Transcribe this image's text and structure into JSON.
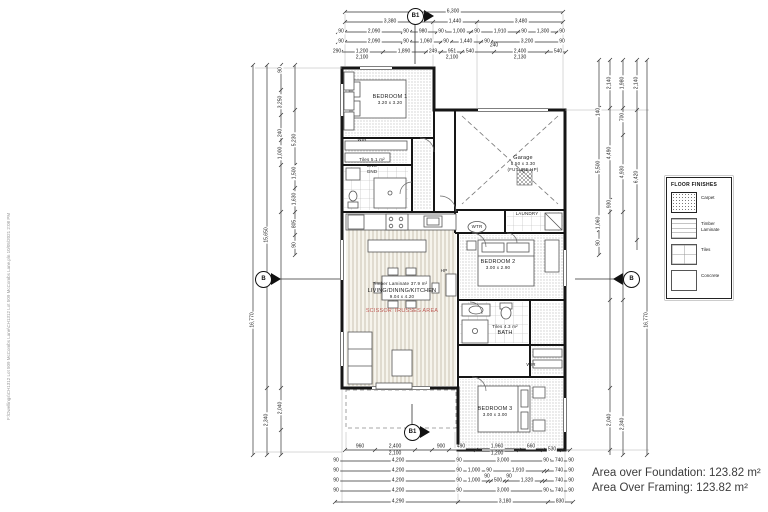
{
  "file_path_text": "F:\\Dwellings\\CH1312 Lot 509 McCombs Lane\\CH1312 Lot 509 McCombs Lane.pln 10/05/2021 2:08 PM",
  "areas": {
    "line1": "Area over Foundation: 123.82 m²",
    "line2": "Area Over Framing: 123.82 m²"
  },
  "markers": {
    "top": "B1",
    "bottom": "B1",
    "left": "B",
    "right": "B"
  },
  "legend": {
    "title": "FLOOR FINISHES",
    "items": [
      {
        "label": "Carpet",
        "swatch": "carpet"
      },
      {
        "label": "Timber Laminate",
        "swatch": "timber"
      },
      {
        "label": "Tiles",
        "swatch": "tiles"
      },
      {
        "label": "Concrete",
        "swatch": "concrete"
      }
    ]
  },
  "room_labels": [
    {
      "t": "BEDROOM 1",
      "x": 390,
      "y": 97
    },
    {
      "t": "3.20 x 3.20",
      "x": 390,
      "y": 103,
      "s": 1
    },
    {
      "t": "WIR",
      "x": 362,
      "y": 140,
      "s": 1
    },
    {
      "t": "Tiles 5.1 m²",
      "x": 372,
      "y": 160,
      "s": 1
    },
    {
      "t": "ENS",
      "x": 372,
      "y": 166,
      "s": 1
    },
    {
      "t": "GND",
      "x": 372,
      "y": 172,
      "s": 1
    },
    {
      "t": "Garage",
      "x": 523,
      "y": 158
    },
    {
      "t": "5.50 x 3.30",
      "x": 523,
      "y": 164,
      "s": 1
    },
    {
      "t": "(FUTURE HP)",
      "x": 523,
      "y": 170,
      "s": 1
    },
    {
      "t": "LAUNDRY",
      "x": 527,
      "y": 214,
      "s": 1
    },
    {
      "t": "WTR",
      "x": 477,
      "y": 227,
      "s": 1
    },
    {
      "t": "BEDROOM 2",
      "x": 498,
      "y": 262
    },
    {
      "t": "3.00 x 2.90",
      "x": 498,
      "y": 268,
      "s": 1
    },
    {
      "t": "Tiles 4.3 m²",
      "x": 505,
      "y": 327,
      "s": 1
    },
    {
      "t": "BATH",
      "x": 505,
      "y": 333
    },
    {
      "t": "WIR",
      "x": 531,
      "y": 365,
      "s": 1
    },
    {
      "t": "BEDROOM 3",
      "x": 495,
      "y": 409
    },
    {
      "t": "3.00 x 3.00",
      "x": 495,
      "y": 415,
      "s": 1
    },
    {
      "t": "Timber Laminate 37.9 m²",
      "x": 400,
      "y": 284,
      "s": 1
    },
    {
      "t": "LIVING/DINING/KITCHEN",
      "x": 402,
      "y": 291
    },
    {
      "t": "9.04 x 4.20",
      "x": 402,
      "y": 297,
      "s": 1
    },
    {
      "t": "SCISSOR TRUSSES AREA",
      "x": 402,
      "y": 311,
      "c": "#bf5b55"
    },
    {
      "t": "HP",
      "x": 444,
      "y": 271,
      "s": 1
    }
  ],
  "dim_labels": [
    {
      "t": "6,300",
      "x": 453,
      "y": 12
    },
    {
      "t": "3,380",
      "x": 390,
      "y": 22
    },
    {
      "t": "1,440",
      "x": 455,
      "y": 22
    },
    {
      "t": "3,480",
      "x": 521,
      "y": 22
    },
    {
      "t": "90",
      "x": 341,
      "y": 32
    },
    {
      "t": "2,090",
      "x": 374,
      "y": 32
    },
    {
      "t": "90",
      "x": 406,
      "y": 32
    },
    {
      "t": "980",
      "x": 423,
      "y": 32
    },
    {
      "t": "90",
      "x": 441,
      "y": 32
    },
    {
      "t": "1,000",
      "x": 459,
      "y": 32
    },
    {
      "t": "90",
      "x": 477,
      "y": 32
    },
    {
      "t": "1,910",
      "x": 500,
      "y": 32
    },
    {
      "t": "90",
      "x": 524,
      "y": 32
    },
    {
      "t": "1,300",
      "x": 543,
      "y": 32
    },
    {
      "t": "90",
      "x": 562,
      "y": 32
    },
    {
      "t": "90",
      "x": 341,
      "y": 42
    },
    {
      "t": "2,090",
      "x": 374,
      "y": 42
    },
    {
      "t": "90",
      "x": 406,
      "y": 42
    },
    {
      "t": "1,060",
      "x": 426,
      "y": 42
    },
    {
      "t": "90",
      "x": 446,
      "y": 42
    },
    {
      "t": "1,440",
      "x": 466,
      "y": 42
    },
    {
      "t": "90",
      "x": 487,
      "y": 42
    },
    {
      "t": "240",
      "x": 494,
      "y": 46
    },
    {
      "t": "3,200",
      "x": 527,
      "y": 42
    },
    {
      "t": "90",
      "x": 562,
      "y": 42
    },
    {
      "t": "290",
      "x": 337,
      "y": 52
    },
    {
      "t": "1,200",
      "x": 362,
      "y": 52
    },
    {
      "t": "1,890",
      "x": 404,
      "y": 52
    },
    {
      "t": "249",
      "x": 433,
      "y": 52
    },
    {
      "t": "951",
      "x": 452,
      "y": 52
    },
    {
      "t": "540",
      "x": 470,
      "y": 52
    },
    {
      "t": "2,400",
      "x": 520,
      "y": 52
    },
    {
      "t": "540",
      "x": 558,
      "y": 52
    },
    {
      "t": "2,100",
      "x": 362,
      "y": 58
    },
    {
      "t": "2,100",
      "x": 452,
      "y": 58
    },
    {
      "t": "2,130",
      "x": 520,
      "y": 58
    },
    {
      "t": "960",
      "x": 360,
      "y": 447
    },
    {
      "t": "2,400",
      "x": 395,
      "y": 447
    },
    {
      "t": "2,100",
      "x": 395,
      "y": 454
    },
    {
      "t": "900",
      "x": 441,
      "y": 447
    },
    {
      "t": "490",
      "x": 461,
      "y": 447
    },
    {
      "t": "1,960",
      "x": 497,
      "y": 447
    },
    {
      "t": "1,200",
      "x": 497,
      "y": 454
    },
    {
      "t": "660",
      "x": 531,
      "y": 447
    },
    {
      "t": "530",
      "x": 552,
      "y": 450
    },
    {
      "t": "90",
      "x": 336,
      "y": 461
    },
    {
      "t": "4,200",
      "x": 398,
      "y": 461
    },
    {
      "t": "90",
      "x": 459,
      "y": 461
    },
    {
      "t": "3,000",
      "x": 503,
      "y": 461
    },
    {
      "t": "90",
      "x": 546,
      "y": 461
    },
    {
      "t": "740",
      "x": 559,
      "y": 461
    },
    {
      "t": "90",
      "x": 571,
      "y": 461
    },
    {
      "t": "90",
      "x": 336,
      "y": 471
    },
    {
      "t": "4,200",
      "x": 398,
      "y": 471
    },
    {
      "t": "90",
      "x": 459,
      "y": 471
    },
    {
      "t": "1,000",
      "x": 474,
      "y": 471
    },
    {
      "t": "90",
      "x": 489,
      "y": 471
    },
    {
      "t": "1,910",
      "x": 518,
      "y": 471
    },
    {
      "t": "740",
      "x": 559,
      "y": 471
    },
    {
      "t": "90",
      "x": 571,
      "y": 471
    },
    {
      "t": "90",
      "x": 336,
      "y": 481
    },
    {
      "t": "4,200",
      "x": 398,
      "y": 481
    },
    {
      "t": "90",
      "x": 459,
      "y": 481
    },
    {
      "t": "1,000",
      "x": 474,
      "y": 481
    },
    {
      "t": "90",
      "x": 487,
      "y": 477
    },
    {
      "t": "500",
      "x": 498,
      "y": 481
    },
    {
      "t": "90",
      "x": 509,
      "y": 477
    },
    {
      "t": "1,320",
      "x": 527,
      "y": 481
    },
    {
      "t": "740",
      "x": 559,
      "y": 481
    },
    {
      "t": "90",
      "x": 571,
      "y": 481
    },
    {
      "t": "90",
      "x": 336,
      "y": 491
    },
    {
      "t": "4,200",
      "x": 398,
      "y": 491
    },
    {
      "t": "90",
      "x": 459,
      "y": 491
    },
    {
      "t": "3,000",
      "x": 503,
      "y": 491
    },
    {
      "t": "90",
      "x": 546,
      "y": 491
    },
    {
      "t": "740",
      "x": 559,
      "y": 491
    },
    {
      "t": "90",
      "x": 571,
      "y": 491
    },
    {
      "t": "4,290",
      "x": 398,
      "y": 502
    },
    {
      "t": "3,180",
      "x": 505,
      "y": 502
    },
    {
      "t": "830",
      "x": 560,
      "y": 502
    },
    {
      "t": "16,770",
      "x": 253,
      "y": 320,
      "r": 1
    },
    {
      "t": "15,650",
      "x": 267,
      "y": 235,
      "r": 1
    },
    {
      "t": "2,340",
      "x": 267,
      "y": 420,
      "r": 1
    },
    {
      "t": "90",
      "x": 281,
      "y": 70,
      "r": 1
    },
    {
      "t": "3,250",
      "x": 281,
      "y": 102,
      "r": 1
    },
    {
      "t": "240",
      "x": 281,
      "y": 133,
      "r": 1
    },
    {
      "t": "1,000",
      "x": 281,
      "y": 153,
      "r": 1
    },
    {
      "t": "2,040",
      "x": 281,
      "y": 408,
      "r": 1
    },
    {
      "t": "5,230",
      "x": 295,
      "y": 140,
      "r": 1
    },
    {
      "t": "1,500",
      "x": 295,
      "y": 173,
      "r": 1
    },
    {
      "t": "1,630",
      "x": 295,
      "y": 199,
      "r": 1
    },
    {
      "t": "805",
      "x": 295,
      "y": 224,
      "r": 1
    },
    {
      "t": "90",
      "x": 295,
      "y": 245,
      "r": 1
    },
    {
      "t": "140",
      "x": 599,
      "y": 112,
      "r": 1
    },
    {
      "t": "5,500",
      "x": 599,
      "y": 167,
      "r": 1
    },
    {
      "t": "1,060",
      "x": 599,
      "y": 223,
      "r": 1
    },
    {
      "t": "90",
      "x": 599,
      "y": 243,
      "r": 1
    },
    {
      "t": "2,140",
      "x": 610,
      "y": 83,
      "r": 1
    },
    {
      "t": "4,490",
      "x": 610,
      "y": 153,
      "r": 1
    },
    {
      "t": "930",
      "x": 610,
      "y": 204,
      "r": 1
    },
    {
      "t": "2,040",
      "x": 610,
      "y": 420,
      "r": 1
    },
    {
      "t": "1,980",
      "x": 623,
      "y": 83,
      "r": 1
    },
    {
      "t": "700",
      "x": 623,
      "y": 117,
      "r": 1
    },
    {
      "t": "4,930",
      "x": 623,
      "y": 172,
      "r": 1
    },
    {
      "t": "2,340",
      "x": 623,
      "y": 424,
      "r": 1
    },
    {
      "t": "2,140",
      "x": 637,
      "y": 83,
      "r": 1
    },
    {
      "t": "6,420",
      "x": 637,
      "y": 177,
      "r": 1
    },
    {
      "t": "16,770",
      "x": 647,
      "y": 320,
      "r": 1
    }
  ],
  "dim_lines": {
    "h": [
      {
        "y": 12,
        "x1": 345,
        "x2": 563,
        "t": [
          345,
          563
        ]
      },
      {
        "y": 22,
        "x1": 345,
        "x2": 563,
        "t": [
          345,
          433,
          477,
          563
        ]
      },
      {
        "y": 32,
        "x1": 338,
        "x2": 565,
        "t": [
          338,
          345,
          403,
          410,
          437,
          444,
          471,
          478,
          518,
          525,
          557,
          564
        ]
      },
      {
        "y": 42,
        "x1": 338,
        "x2": 565,
        "t": [
          338,
          345,
          403,
          410,
          441,
          451,
          481,
          491,
          563
        ]
      },
      {
        "y": 52,
        "x1": 334,
        "x2": 566,
        "t": [
          334,
          341,
          383,
          426,
          441,
          462,
          494,
          547,
          566
        ]
      },
      {
        "y": 450,
        "x1": 345,
        "x2": 570,
        "t": [
          345,
          375,
          415,
          432,
          449,
          476,
          519,
          543,
          562,
          570
        ]
      },
      {
        "y": 461,
        "x1": 335,
        "x2": 573,
        "t": [
          335,
          338,
          458,
          461,
          546,
          549,
          570,
          573
        ]
      },
      {
        "y": 471,
        "x1": 335,
        "x2": 573,
        "t": [
          335,
          338,
          458,
          461,
          488,
          491,
          544,
          547,
          570,
          573
        ]
      },
      {
        "y": 481,
        "x1": 335,
        "x2": 573,
        "t": [
          335,
          338,
          458,
          461,
          488,
          491,
          504,
          507,
          542,
          545,
          570,
          573
        ]
      },
      {
        "y": 491,
        "x1": 335,
        "x2": 573,
        "t": [
          335,
          338,
          458,
          461,
          546,
          549,
          570,
          573
        ]
      },
      {
        "y": 502,
        "x1": 335,
        "x2": 573,
        "t": [
          335,
          458,
          548,
          573
        ]
      }
    ],
    "v": [
      {
        "x": 253,
        "y1": 65,
        "y2": 455,
        "t": [
          65,
          455
        ]
      },
      {
        "x": 267,
        "y1": 65,
        "y2": 455,
        "t": [
          65,
          388,
          455
        ]
      },
      {
        "x": 281,
        "y1": 65,
        "y2": 455,
        "t": [
          65,
          90,
          115,
          140,
          165,
          212,
          388,
          430,
          455
        ]
      },
      {
        "x": 295,
        "y1": 65,
        "y2": 255,
        "t": [
          65,
          110,
          140,
          165,
          188,
          212,
          235,
          255
        ]
      },
      {
        "x": 599,
        "y1": 60,
        "y2": 255,
        "t": [
          60,
          108,
          230,
          255
        ]
      },
      {
        "x": 610,
        "y1": 60,
        "y2": 455,
        "t": [
          60,
          108,
          200,
          212,
          300,
          388,
          450
        ]
      },
      {
        "x": 623,
        "y1": 60,
        "y2": 455,
        "t": [
          60,
          108,
          135,
          212,
          300,
          455
        ]
      },
      {
        "x": 637,
        "y1": 60,
        "y2": 250,
        "t": [
          60,
          110,
          240
        ]
      },
      {
        "x": 647,
        "y1": 60,
        "y2": 455,
        "t": [
          60,
          455
        ]
      }
    ]
  }
}
